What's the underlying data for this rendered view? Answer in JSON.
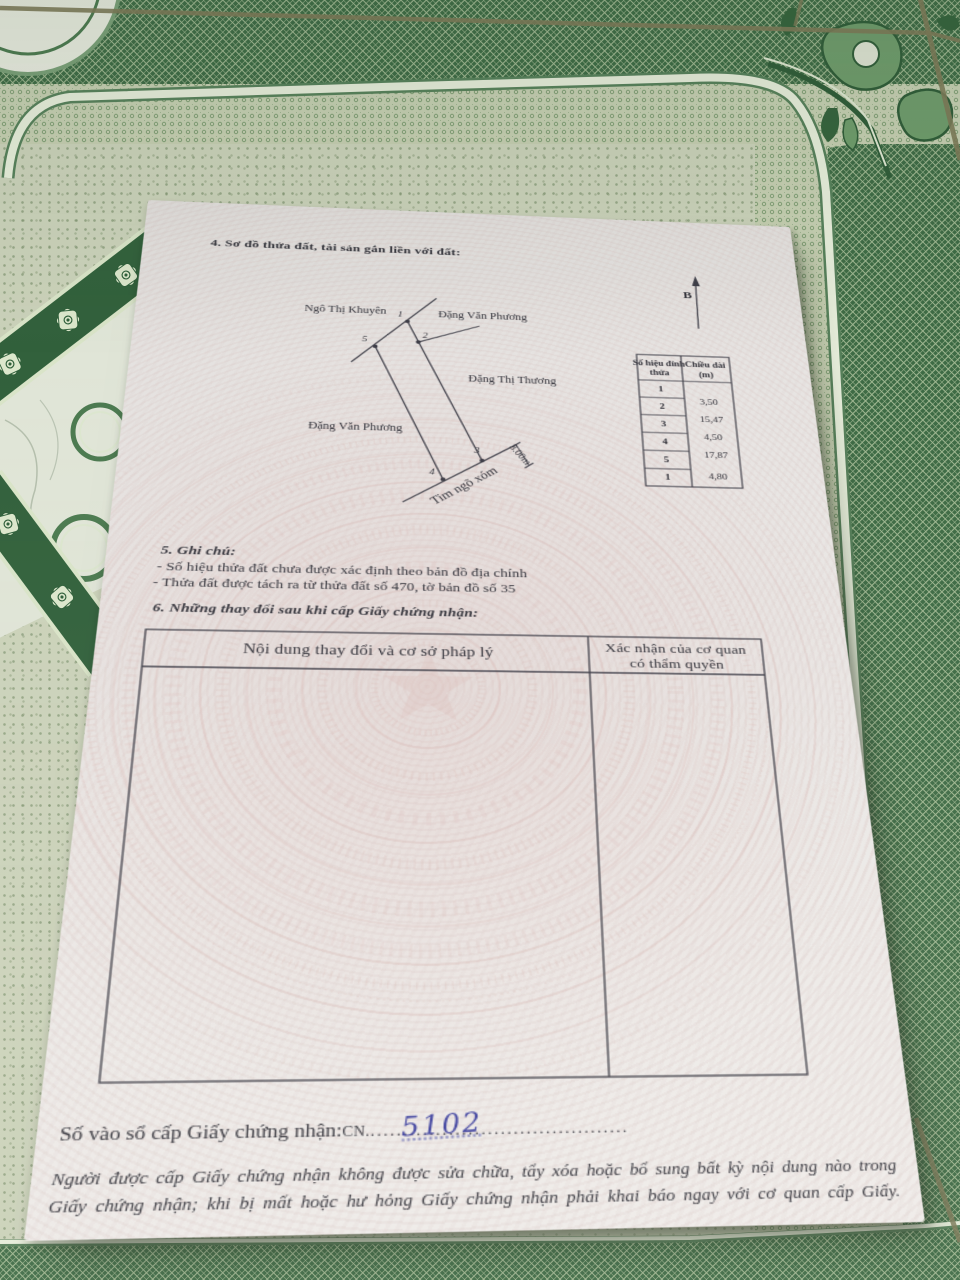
{
  "colors": {
    "paper": "#e9e6e4",
    "ink": "#32323a",
    "rule_line": "#42424a",
    "handwriting_blue": "#3c3f9e",
    "watermark_pink": "#d8b4b0",
    "tile_dark_green": "#3e6b45",
    "tile_light_green": "#cbd2ba"
  },
  "section4": {
    "title": "4. Sơ đồ thửa đất, tài sản gắn liền với đất:"
  },
  "compass": {
    "label": "B"
  },
  "diagram": {
    "neighbor_top_left": "Ngô Thị Khuyên",
    "neighbor_top_right": "Đặng Văn Phương",
    "neighbor_right": "Đặng Thị Thương",
    "neighbor_left": "Đặng Văn Phương",
    "alley_label": "Tim ngõ xóm",
    "alley_width": "3.00m",
    "vertex_1": "1",
    "vertex_2": "2",
    "vertex_3": "3",
    "vertex_4": "4",
    "vertex_5": "5"
  },
  "vertex_table": {
    "header_col1_line1": "Số hiệu đỉnh",
    "header_col1_line2": "thửa",
    "header_col2_line1": "Chiều dài",
    "header_col2_line2": "(m)",
    "rows": [
      "1",
      "2",
      "3",
      "4",
      "5",
      "1"
    ],
    "lengths": [
      "3,50",
      "15,47",
      "4,50",
      "17,87",
      "4,80"
    ]
  },
  "section5": {
    "title": "5. Ghi chú:",
    "note1": "- Số hiệu thửa đất chưa được xác định theo bản đồ địa chính",
    "note2": "- Thửa đất được tách ra từ thửa đất số 470, tờ bản đồ số 35"
  },
  "section6": {
    "title": "6. Những thay đổi sau khi cấp Giấy chứng nhận:",
    "col1_header": "Nội dung thay đổi và cơ sở pháp lý",
    "col2_header_line1": "Xác nhận của cơ quan",
    "col2_header_line2": "có thẩm quyền"
  },
  "registry": {
    "label": "Số vào sổ cấp Giấy chứng nhận:",
    "prefix": "CN.",
    "number": "5102",
    "dotted_leader": "........................................"
  },
  "notice": {
    "line1": "Người được cấp Giấy chứng nhận không được sửa chữa, tẩy xóa hoặc bổ sung bất kỳ nội dung nào trong",
    "line2": "Giấy chứng nhận; khi bị mất hoặc hư hỏng Giấy chứng nhận phải khai báo ngay với cơ quan cấp Giấy."
  }
}
